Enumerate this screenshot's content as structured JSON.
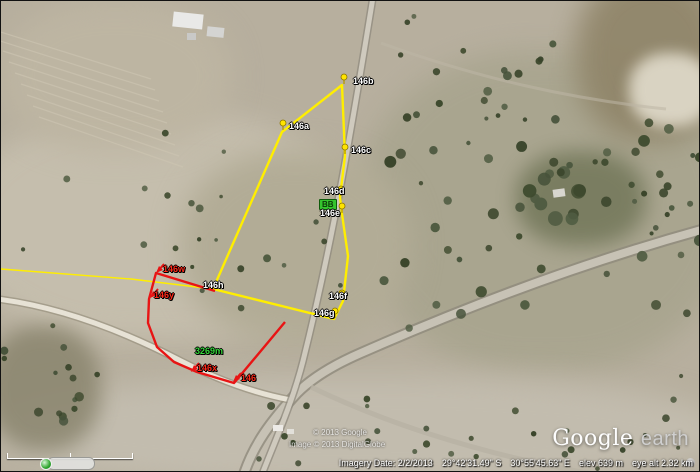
{
  "map": {
    "parcels": {
      "yellow": {
        "color": "#ffee00",
        "width": 2.4,
        "closed": true,
        "points": [
          [
            341,
            84
          ],
          [
            344,
            155
          ],
          [
            339,
            196
          ],
          [
            341,
            213
          ],
          [
            347,
            255
          ],
          [
            342,
            300
          ],
          [
            333,
            318
          ],
          [
            212,
            288
          ],
          [
            281,
            131
          ]
        ]
      },
      "yellow_line": {
        "color": "#ffee00",
        "width": 1.4,
        "closed": false,
        "points": [
          [
            0,
            268
          ],
          [
            130,
            278
          ],
          [
            212,
            288
          ]
        ]
      },
      "red": {
        "color": "#e81414",
        "width": 2.4,
        "closed": false,
        "points": [
          [
            214,
            290
          ],
          [
            155,
            272
          ],
          [
            148,
            298
          ],
          [
            147,
            322
          ],
          [
            156,
            346
          ],
          [
            173,
            361
          ],
          [
            196,
            371
          ],
          [
            233,
            382
          ],
          [
            284,
            321
          ]
        ]
      }
    },
    "pins": [
      [
        343,
        83
      ],
      [
        282,
        129
      ],
      [
        344,
        153
      ],
      [
        340,
        195
      ],
      [
        341,
        212
      ],
      [
        341,
        299
      ],
      [
        334,
        317
      ]
    ],
    "arrows": [
      [
        155,
        272
      ],
      [
        149,
        297
      ],
      [
        190,
        371
      ],
      [
        232,
        381
      ]
    ],
    "labels": [
      {
        "text": "146b",
        "x": 352,
        "y": 75,
        "color": "white"
      },
      {
        "text": "146a",
        "x": 288,
        "y": 120,
        "color": "white"
      },
      {
        "text": "146c",
        "x": 350,
        "y": 144,
        "color": "white"
      },
      {
        "text": "146d",
        "x": 323,
        "y": 185,
        "color": "white"
      },
      {
        "text": "BB",
        "x": 318,
        "y": 198,
        "color": "green-box"
      },
      {
        "text": "146e",
        "x": 319,
        "y": 207,
        "color": "white"
      },
      {
        "text": "146f",
        "x": 328,
        "y": 290,
        "color": "white"
      },
      {
        "text": "146g",
        "x": 313,
        "y": 307,
        "color": "white"
      },
      {
        "text": "146h",
        "x": 202,
        "y": 279,
        "color": "white"
      },
      {
        "text": "146w",
        "x": 162,
        "y": 263,
        "color": "red"
      },
      {
        "text": "146y",
        "x": 153,
        "y": 289,
        "color": "red"
      },
      {
        "text": "146x",
        "x": 196,
        "y": 362,
        "color": "red"
      },
      {
        "text": "146",
        "x": 240,
        "y": 372,
        "color": "red"
      },
      {
        "text": "3269m",
        "x": 194,
        "y": 345,
        "color": "green"
      }
    ]
  },
  "watermark": {
    "line1": "© 2013 Google",
    "line2": "Image © 2013 DigitalGlobe"
  },
  "logo": {
    "google": "Google",
    "earth": "earth"
  },
  "statusbar": {
    "imagery_date": "Imagery Date: 2/2/2013",
    "lat": "29°42'31.49\" S",
    "lon": "30°55'45.63\" E",
    "elev": "elev 639 m",
    "eye_alt": "eye alt  2.32 km"
  }
}
